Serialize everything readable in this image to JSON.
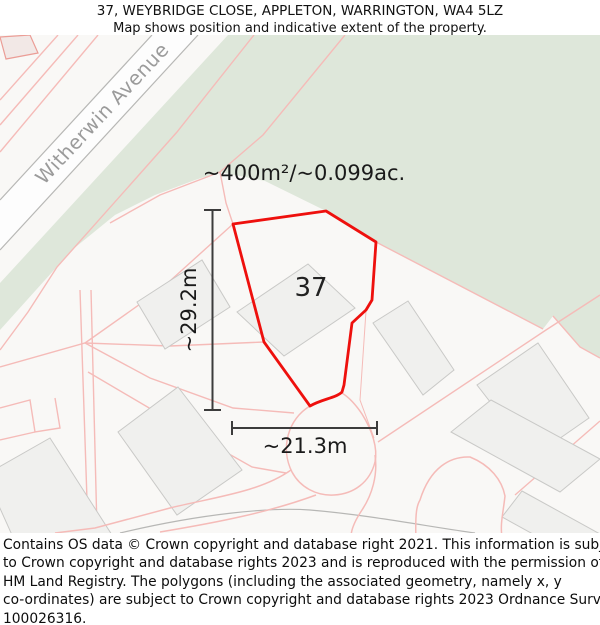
{
  "header": {
    "title": "37, WEYBRIDGE CLOSE, APPLETON, WARRINGTON, WA4 5LZ",
    "subtitle": "Map shows position and indicative extent of the property."
  },
  "map": {
    "street_label": "Witherwin Avenue",
    "plot_number": "37",
    "area_label": "~400m²/~0.099ac.",
    "height_label": "~29.2m",
    "width_label": "~21.3m"
  },
  "colors": {
    "background": "#f9f8f6",
    "green_area": "#dee7da",
    "parcel_line_pink": "#f5bbb8",
    "property_outline_red": "#ee100d",
    "building_fill": "#f0f0ee",
    "building_stroke": "#c9c9c7",
    "road_edge_gray": "#b7b7b5",
    "measurement": "#3c3c3c",
    "street_text": "#9b9b9b"
  },
  "footer": {
    "lines": [
      "Contains OS data © Crown copyright and database right 2021. This information is subject",
      "to Crown copyright and database rights 2023 and is reproduced with the permission of",
      "HM Land Registry. The polygons (including the associated geometry, namely x, y",
      "co-ordinates) are subject to Crown copyright and database rights 2023 Ordnance Survey",
      "100026316."
    ]
  }
}
